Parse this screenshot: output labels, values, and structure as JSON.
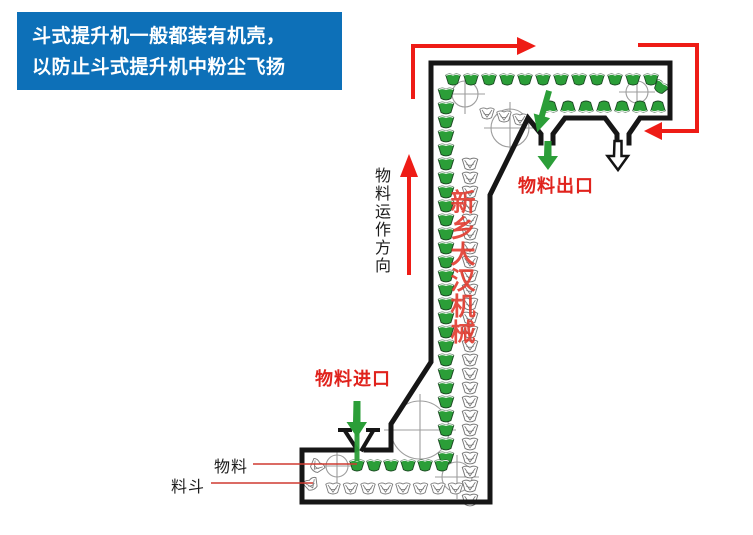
{
  "info_box": {
    "line1": "斗式提升机一般都装有机壳，",
    "line2": "以防止斗式提升机中粉尘飞扬"
  },
  "labels": {
    "flow_direction": "物料运作方向",
    "material_outlet": "物料出口",
    "material_inlet": "物料进口",
    "material": "物料",
    "bucket": "料斗"
  },
  "watermark": "新乡大汉机械",
  "icons": {
    "flow_direction_arrow": "red-up-arrow",
    "belt_path_arrows": "red-right-angle-arrows",
    "inlet_arrow": "green-down-arrow",
    "outlet_arrow_full": "green-down-arrow",
    "outlet_arrow_return": "white-down-arrow"
  },
  "colors": {
    "info_bg": "#0d70b8",
    "info_text": "#ffffff",
    "arrow_red": "#ee1c16",
    "label_red": "#e0231d",
    "watermark_red": "#e23a2e",
    "bucket_green": "#2b9e38",
    "casing_black": "#161616",
    "leader_red": "#cf3a30",
    "text_black": "#1c1c1c"
  }
}
